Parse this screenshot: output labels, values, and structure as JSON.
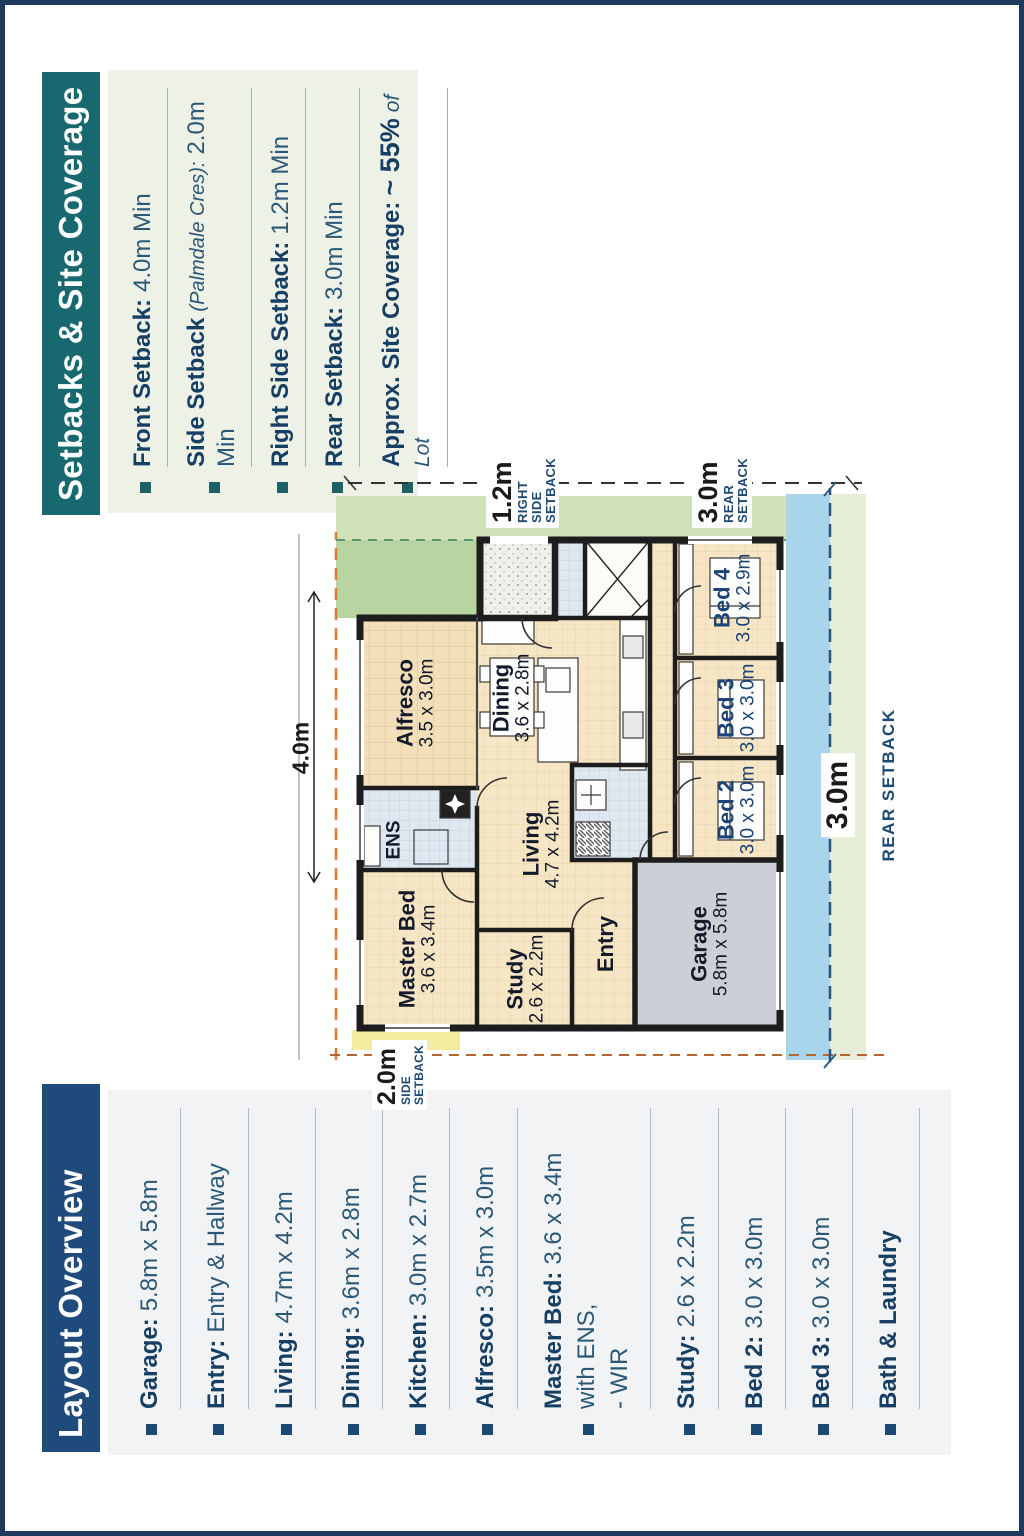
{
  "page": {
    "frame_color": "#203a5e",
    "background": "#ffffff"
  },
  "setbacks_panel": {
    "title": "Setbacks & Site Coverage",
    "header_bg": "#17696f",
    "panel_bg": "#edf1e6",
    "items": [
      {
        "label": "Front Setback:",
        "value": "4.0m Min"
      },
      {
        "label": "Side Setback",
        "note": "(Palmdale Cres):",
        "value": "2.0m Min"
      },
      {
        "label": "Right Side Setback:",
        "value": "1.2m Min"
      },
      {
        "label": "Rear Setback:",
        "value": "3.0m Min"
      },
      {
        "label": "Approx. Site Coverage:",
        "value": "~ 55%",
        "suffix": "of Lot"
      }
    ]
  },
  "layout_panel": {
    "title": "Layout Overview",
    "header_bg": "#1f4b7c",
    "panel_bg": "#f2f3f5",
    "items": [
      {
        "label": "Garage:",
        "value": "5.8m x 5.8m"
      },
      {
        "label": "Entry:",
        "value": "Entry & Hallway"
      },
      {
        "label": "Living:",
        "value": "4.7m x 4.2m"
      },
      {
        "label": "Dining:",
        "value": "3.6m x 2.8m"
      },
      {
        "label": "Kitchen:",
        "value": "3.0m x 2.7m"
      },
      {
        "label": "Alfresco:",
        "value": "3.5m x 3.0m"
      },
      {
        "label": "Master Bed:",
        "value": "3.6 x 3.4m",
        "extra1": "with ENS,",
        "extra2": "- WIR"
      },
      {
        "label": "Study:",
        "value": "2.6 x 2.2m"
      },
      {
        "label": "Bed 2:",
        "value": "3.0 x 3.0m"
      },
      {
        "label": "Bed 3:",
        "value": "3.0 x 3.0m"
      },
      {
        "label": "Bath & Laundry",
        "value": ""
      }
    ]
  },
  "floor_plan": {
    "rooms": [
      {
        "name": "Master Bed",
        "dims": "3.6 x 3.4m"
      },
      {
        "name": "ENS",
        "dims": ""
      },
      {
        "name": "Alfresco",
        "dims": "3.5 x 3.0m"
      },
      {
        "name": "Study",
        "dims": "2.6 x 2.2m"
      },
      {
        "name": "Living",
        "dims": "4.7 x 4.2m"
      },
      {
        "name": "Dining",
        "dims": "3.6 x 2.8m"
      },
      {
        "name": "Entry",
        "dims": ""
      },
      {
        "name": "Garage",
        "dims": "5.8m x 5.8m"
      },
      {
        "name": "Bed 2",
        "dims": "3.0 x 3.0m"
      },
      {
        "name": "Bed 3",
        "dims": "3.0 x 3.0m"
      },
      {
        "name": "Bed 4",
        "dims": "3.0 x 2.9m"
      }
    ],
    "setbacks": [
      {
        "dim": "4.0m",
        "lines": []
      },
      {
        "dim": "1.2m",
        "lines": [
          "RIGHT",
          "SIDE",
          "SETBACK"
        ]
      },
      {
        "dim": "3.0m",
        "lines": [
          "REAR",
          "SETBACK"
        ]
      },
      {
        "dim": "2.0m",
        "lines": [
          "SIDE",
          "SETBACK"
        ]
      },
      {
        "dim": "3.0m",
        "lines": [
          "REAR SETBACK"
        ]
      }
    ],
    "zone_colors": {
      "side_green": "#cfe2b8",
      "corner_green": "#b8d4a0",
      "rear_blue": "#a9d5ec",
      "rear_pale_green": "#e6edd8",
      "side_yellow": "#f3eda2",
      "boundary_orange": "#dd7733",
      "boundary_navy": "#27557f"
    }
  }
}
